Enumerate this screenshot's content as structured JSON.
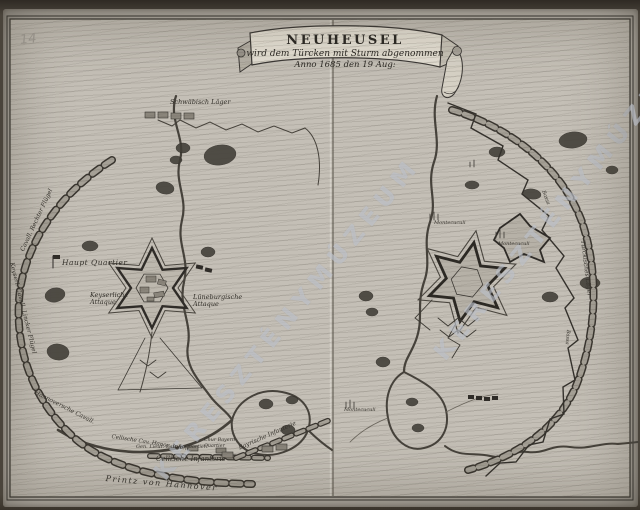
{
  "artifact": {
    "page_number": "14",
    "watermark": "KERESZTÉNYMÚZEUM"
  },
  "banner": {
    "title": "NEUHEUSEL",
    "subtitle": "wird dem Türcken mit Sturm abgenommen",
    "dateline": "Anno 1685 den 19 Aug:"
  },
  "left_map": {
    "labels": {
      "schwaebisch_lager": "Schwäbisch Läger",
      "haupt_quartier": "Haupt Quartier",
      "keyserliche_attaque": "Keyserliche Attaque",
      "luneburgische_attaque": "Lüneburgische Attaque",
      "cavall_rechter_fluegel": "Cavall. Rechter Flügel",
      "keyserl_cavall_lincker_fluegel": "Keyserl. Cavall. Lincker Flügel",
      "hannoversche_cavall": "Hannoversche Cavall.",
      "cellische_cav": "Cellische Cav. Hanov. Infant.",
      "gen_lieut_quartier": "Gen. Lieut. Cavall. Quartier",
      "cellische_infanterie": "Cellische Infanterie",
      "chur_bayern_quartier": "Chur Bayern Quartier",
      "bayrische_infanterie": "Bayrische Infanterie",
      "printz_von_hannover": "Printz von Hannover"
    }
  },
  "right_map": {
    "labels": {
      "montecuculi_1": "Montecuculi",
      "montecuculi_2": "Montecuculi",
      "montecuculi_3": "Montecuculi",
      "tuerkisches_lager": "Türckisches Läger",
      "bassa_1": "Bassa",
      "bassa_2": "Bassa"
    }
  }
}
